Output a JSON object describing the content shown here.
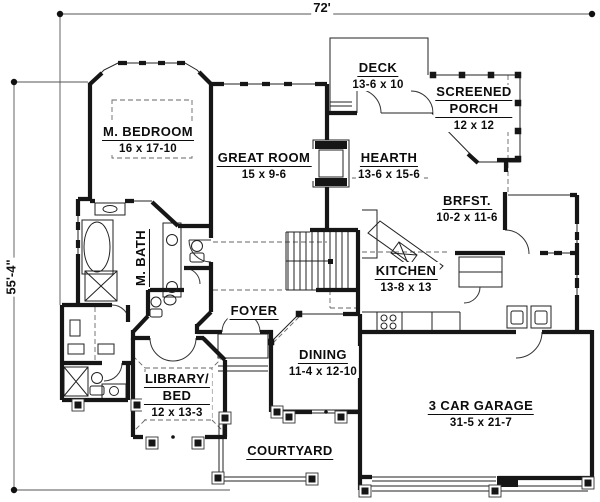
{
  "plan": {
    "title": "house floor plan",
    "dimensions": {
      "width_label": "72'",
      "height_label": "55'-4\""
    },
    "rooms": {
      "m_bedroom": {
        "name": "M. BEDROOM",
        "size": "16 x 17-10"
      },
      "great_room": {
        "name": "GREAT ROOM",
        "size": "15 x 9-6"
      },
      "deck": {
        "name": "DECK",
        "size": "13-6 x 10"
      },
      "screened_porch": {
        "name_line1": "SCREENED",
        "name_line2": "PORCH",
        "size": "12 x 12"
      },
      "hearth": {
        "name": "HEARTH",
        "size": "13-6 x 15-6"
      },
      "brfst": {
        "name": "BRFST.",
        "size": "10-2 x 11-6"
      },
      "m_bath": {
        "name": "M. BATH"
      },
      "kitchen": {
        "name": "KITCHEN",
        "size": "13-8 x 13"
      },
      "foyer": {
        "name": "FOYER"
      },
      "dining": {
        "name": "DINING",
        "size": "11-4 x 12-10"
      },
      "library_bed": {
        "name_line1": "LIBRARY/",
        "name_line2": "BED",
        "size": "12 x 13-3"
      },
      "courtyard": {
        "name": "COURTYARD"
      },
      "garage": {
        "name": "3 CAR GARAGE",
        "size": "31-5 x 21-7"
      }
    },
    "colors": {
      "wall": "#161616",
      "thin": "#222222",
      "dash": "#666666"
    }
  }
}
